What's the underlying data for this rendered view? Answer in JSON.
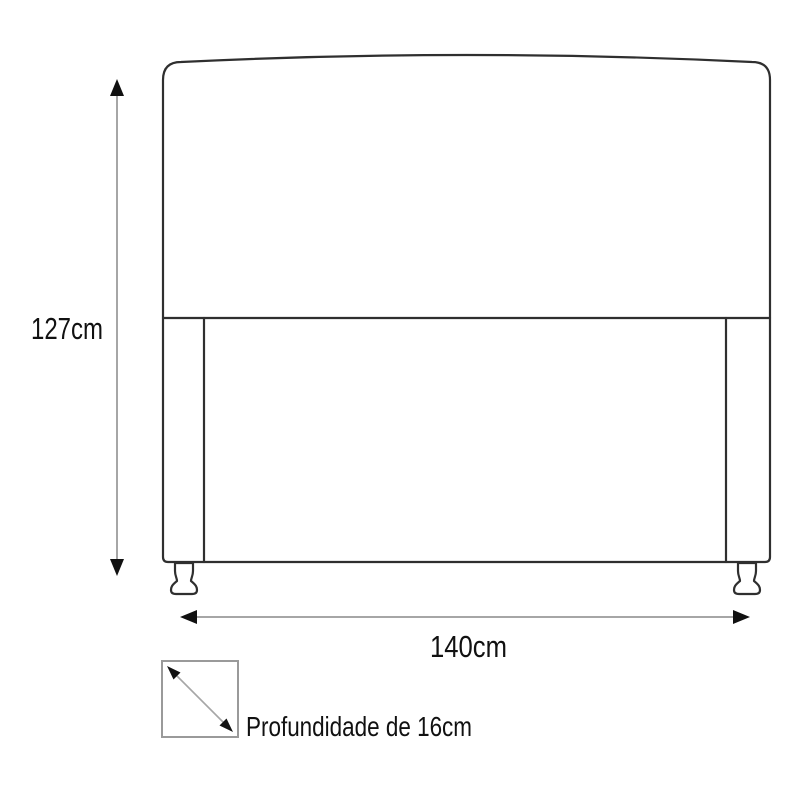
{
  "colors": {
    "outline": "#2f2f2f",
    "dimension_line": "#a6a6a6",
    "arrowhead": "#111111",
    "depth_box_border": "#9a9a9a",
    "text": "#111111",
    "background": "#ffffff"
  },
  "diagram": {
    "height_label": "127cm",
    "width_label": "140cm",
    "depth_label": "Profundidade de 16cm",
    "height_cm": 127,
    "width_cm": 140,
    "depth_cm": 16
  }
}
